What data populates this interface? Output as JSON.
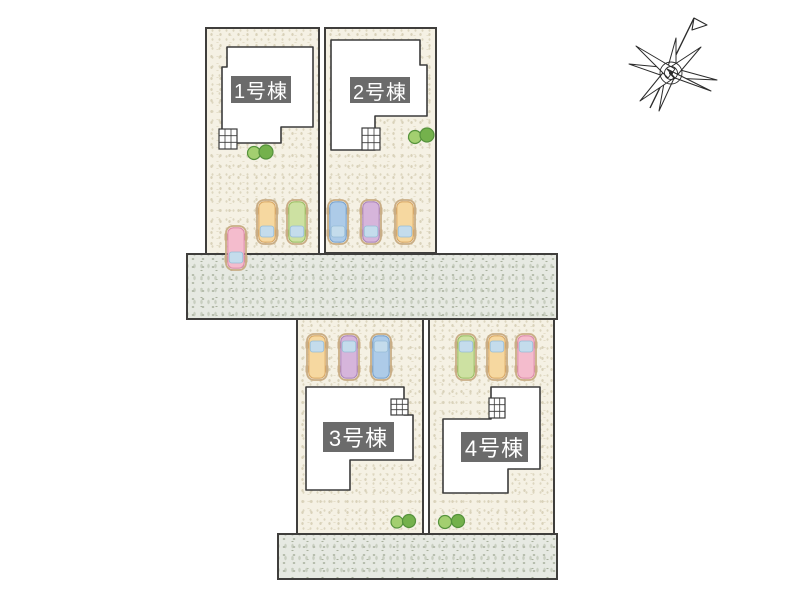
{
  "site_plan": {
    "title": "site-layout-plan",
    "lots": [
      {
        "id": "1",
        "label": "1号棟"
      },
      {
        "id": "2",
        "label": "2号棟"
      },
      {
        "id": "3",
        "label": "3号棟"
      },
      {
        "id": "4",
        "label": "4号棟"
      }
    ],
    "colors": {
      "ground": "#f5f1e4",
      "road": "#e6e9e2",
      "outline": "#3f3e3c",
      "building_fill": "#ffffff",
      "badge_bg": "#6b6b6b",
      "badge_text": "#ffffff",
      "windshield": "#c4dcec",
      "windshield_edge": "#96bcd6",
      "car_aura": "#c9ad85",
      "tree_light": "#a3cf70",
      "tree_dark": "#74b14c",
      "tree_stroke": "#55923c",
      "car": {
        "orange": {
          "body": "#f6d8a0",
          "edge": "#d9a763"
        },
        "green": {
          "body": "#cde1a2",
          "edge": "#9cbd63"
        },
        "blue": {
          "body": "#adcbe8",
          "edge": "#79a3cf"
        },
        "purple": {
          "body": "#d6b5db",
          "edge": "#ad85bb"
        },
        "pink": {
          "body": "#f4bccd",
          "edge": "#dd8aa8"
        }
      }
    },
    "cars": [
      {
        "lot": "1",
        "color": "pink",
        "dir": "down",
        "x": 226,
        "y": 226
      },
      {
        "lot": "1",
        "color": "orange",
        "dir": "down",
        "x": 257,
        "y": 200
      },
      {
        "lot": "1",
        "color": "green",
        "dir": "down",
        "x": 287,
        "y": 200
      },
      {
        "lot": "2",
        "color": "blue",
        "dir": "down",
        "x": 328,
        "y": 200
      },
      {
        "lot": "2",
        "color": "purple",
        "dir": "down",
        "x": 361,
        "y": 200
      },
      {
        "lot": "2",
        "color": "orange",
        "dir": "down",
        "x": 395,
        "y": 200
      },
      {
        "lot": "3",
        "color": "orange",
        "dir": "up",
        "x": 307,
        "y": 334
      },
      {
        "lot": "3",
        "color": "purple",
        "dir": "up",
        "x": 339,
        "y": 334
      },
      {
        "lot": "3",
        "color": "blue",
        "dir": "up",
        "x": 371,
        "y": 334
      },
      {
        "lot": "4",
        "color": "green",
        "dir": "up",
        "x": 456,
        "y": 334
      },
      {
        "lot": "4",
        "color": "orange",
        "dir": "up",
        "x": 487,
        "y": 334
      },
      {
        "lot": "4",
        "color": "pink",
        "dir": "up",
        "x": 516,
        "y": 334
      }
    ],
    "trees": [
      {
        "x": 254,
        "y": 153,
        "r": 6.5,
        "tone": "light"
      },
      {
        "x": 266,
        "y": 152,
        "r": 7.0,
        "tone": "dark"
      },
      {
        "x": 415,
        "y": 137,
        "r": 6.5,
        "tone": "light"
      },
      {
        "x": 427,
        "y": 135,
        "r": 7.0,
        "tone": "dark"
      },
      {
        "x": 397,
        "y": 522,
        "r": 6.0,
        "tone": "light"
      },
      {
        "x": 409,
        "y": 521,
        "r": 6.5,
        "tone": "dark"
      },
      {
        "x": 445,
        "y": 522,
        "r": 6.5,
        "tone": "light"
      },
      {
        "x": 458,
        "y": 521,
        "r": 6.5,
        "tone": "dark"
      }
    ]
  }
}
